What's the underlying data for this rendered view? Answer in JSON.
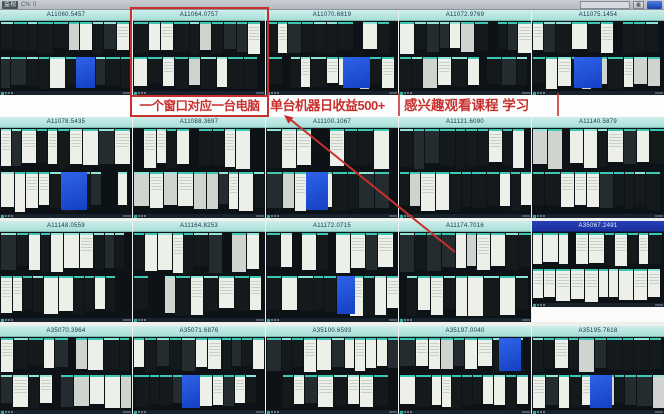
{
  "titlebar": {
    "app_label": "监视",
    "status": "CN: 0",
    "search_value": ""
  },
  "annotations": {
    "window_note": "一个窗口对应一台电脑",
    "income_note": "单台机器日收益500+",
    "course_note": "感兴趣观看课程 学习"
  },
  "panels": [
    {
      "id": "A11060.5457",
      "selected": false
    },
    {
      "id": "A11064.0757",
      "selected": false
    },
    {
      "id": "A11070.6819",
      "selected": false
    },
    {
      "id": "A11072.9769",
      "selected": false
    },
    {
      "id": "A11075.1454",
      "selected": false
    },
    {
      "id": "A11078.5435",
      "selected": false
    },
    {
      "id": "A11088.3697",
      "selected": false
    },
    {
      "id": "A11100.1067",
      "selected": false
    },
    {
      "id": "A11121.6090",
      "selected": false
    },
    {
      "id": "A11140.5879",
      "selected": false
    },
    {
      "id": "A11148.0559",
      "selected": false
    },
    {
      "id": "A11164.8253",
      "selected": false
    },
    {
      "id": "A11172.0715",
      "selected": false
    },
    {
      "id": "A11174.7016",
      "selected": false
    },
    {
      "id": "A35067.2491",
      "selected": true
    },
    {
      "id": "A35070.3964",
      "selected": false
    },
    {
      "id": "A35071.6876",
      "selected": false
    },
    {
      "id": "A35100.6593",
      "selected": false
    },
    {
      "id": "A35197.0040",
      "selected": false
    },
    {
      "id": "A35195.7618",
      "selected": false
    }
  ],
  "colors": {
    "annotation_red": "#c8302e",
    "panel_header_bg": "#a9ded8",
    "panel_header_bg2": "#cdeeea",
    "panel_header_text": "#173248",
    "selected_header_bg": "#1b2f9e",
    "selected_header_text": "#eef2ff",
    "screen_bg": "#0d1216",
    "mini_window_dark": "#14191c",
    "mini_window_mid": "#242c30",
    "mini_window_light": "#edefe9",
    "mini_window_gray": "#cfd4cf",
    "mini_titlebar_teal": "#3cc8b4",
    "mini_titlebar_pale": "#93e4d8",
    "desktop_blue": "#1f4fd2",
    "topbar_bg": "#b3b8c0"
  }
}
